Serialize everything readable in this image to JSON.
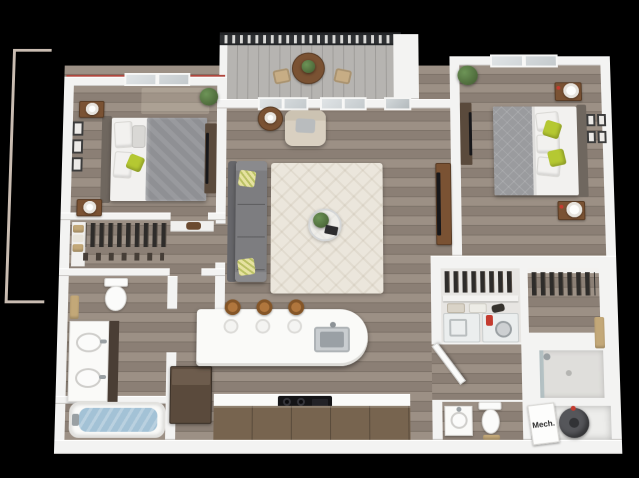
{
  "scene": {
    "description": "3D rendered top-down floor plan of a two-bedroom, two-bathroom apartment with balcony, open living room and island kitchen, on a black background",
    "view": "axonometric-top-down",
    "background": "#000000"
  },
  "labels": {
    "mech_room": "Mech."
  },
  "colors": {
    "bg": "#000000",
    "wall": "#f3f3f2",
    "wallEdge": "#c9c7c4",
    "floorA": "#9c9085",
    "floorB": "#8b7f75",
    "floorLine": "#7d7268",
    "balconyFloor": "#b6b4b1",
    "railing": "#2e3033",
    "accentGreen": "#b5c832",
    "plantGreen": "#6d9457",
    "plantDark": "#41592f",
    "sofa": "#7d7d80",
    "sofaDark": "#66666a",
    "armchair": "#d9d0c1",
    "rug": "#ebe6dc",
    "woodBrown": "#7a5233",
    "darkCabinet": "#5a4a3c",
    "counterWhite": "#fafaf8",
    "cabinetBrown": "#77644f",
    "stoolWood": "#b0763d",
    "tubWater": "#a3c2d6",
    "applianceDark": "#17171a",
    "duvetGray": "#8f9094",
    "bedWhite": "#f2f1ef",
    "headboard": "#6f675f",
    "frameDark": "#3c3c3c",
    "towelTan": "#c3a878",
    "redAccent": "#c43b2f",
    "roofRed": "#b0473e",
    "heaterGray": "#55565a",
    "mechText": "#2b2b2b",
    "neighborOutline": "#c9bcb1"
  },
  "rooms": [
    {
      "id": "bedroom-1",
      "position": "top-left",
      "furniture": [
        "queen-bed",
        "tufted-headboard",
        "gray-patterned-duvet",
        "green-accent-pillow",
        "nightstand-with-lamp-north",
        "nightstand-with-lamp-south",
        "three-wall-frames",
        "window",
        "potted-plant",
        "tv-dresser"
      ]
    },
    {
      "id": "walk-in-closet-1",
      "position": "left",
      "furniture": [
        "hanging-clothes-rod",
        "linen-shelf-with-towels",
        "shelf-with-bag",
        "shoe-row"
      ]
    },
    {
      "id": "bathroom-1",
      "position": "lower-left",
      "furniture": [
        "toilet",
        "wall-towels",
        "double-vanity-two-sinks",
        "bathtub-with-water"
      ]
    },
    {
      "id": "balcony",
      "position": "top-center",
      "furniture": [
        "slatted-railing",
        "round-bistro-table",
        "table-plant",
        "patio-chair-left",
        "patio-chair-right"
      ]
    },
    {
      "id": "living-room",
      "position": "center",
      "furniture": [
        "gray-sofa",
        "patterned-throw-pillows",
        "cream-armchair",
        "round-side-table-with-lamp",
        "area-rug",
        "glass-coffee-table",
        "coffee-table-plant",
        "tv-console",
        "window-left",
        "window-right",
        "balcony-glass-door"
      ]
    },
    {
      "id": "kitchen",
      "position": "bottom-center",
      "bar_stools": 3,
      "furniture": [
        "white-island-rounded-end",
        "island-sink",
        "three-place-settings",
        "three-bar-stools",
        "refrigerator",
        "gas-cooktop",
        "lower-cabinets",
        "countertop"
      ]
    },
    {
      "id": "bedroom-2",
      "position": "top-right",
      "furniture": [
        "queen-bed",
        "headboard-east",
        "gray-quilt",
        "green-pillows",
        "nightstand-with-drum-lamp-north",
        "nightstand-with-drum-lamp-south",
        "four-wall-frames",
        "window",
        "potted-plant",
        "tv-dresser"
      ]
    },
    {
      "id": "closet-2",
      "position": "right",
      "furniture": [
        "hanging-clothes-rod"
      ]
    },
    {
      "id": "laundry-closet",
      "position": "center-right",
      "furniture": [
        "hanging-clothes-rod",
        "shelf-with-baskets",
        "washer",
        "dryer-with-detergent"
      ]
    },
    {
      "id": "bathroom-2",
      "position": "bottom-right",
      "furniture": [
        "vanity-with-round-sink",
        "toilet",
        "wood-tray",
        "walk-in-shower-glass",
        "wall-towel"
      ]
    },
    {
      "id": "mechanical-room",
      "position": "bottom-right-corner",
      "furniture": [
        "water-heater",
        "labeled-door-panel"
      ]
    }
  ]
}
